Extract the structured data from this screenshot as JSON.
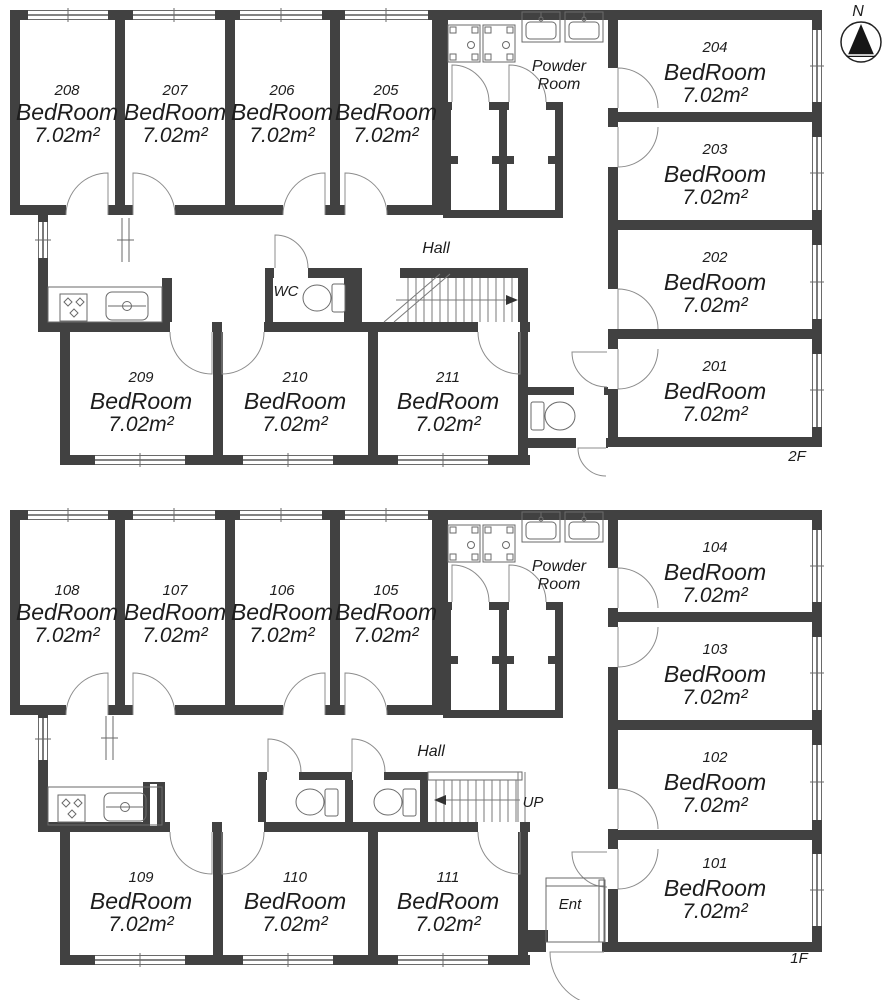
{
  "compass": {
    "north": "N"
  },
  "floor_2f": {
    "floor_label": "2F",
    "hall_label": "Hall",
    "wc_label": "WC",
    "powder_line1": "Powder",
    "powder_line2": "Room",
    "rooms_top": [
      {
        "number": "208",
        "type": "BedRoom",
        "area": "7.02m²"
      },
      {
        "number": "207",
        "type": "BedRoom",
        "area": "7.02m²"
      },
      {
        "number": "206",
        "type": "BedRoom",
        "area": "7.02m²"
      },
      {
        "number": "205",
        "type": "BedRoom",
        "area": "7.02m²"
      }
    ],
    "rooms_right": [
      {
        "number": "204",
        "type": "BedRoom",
        "area": "7.02m²"
      },
      {
        "number": "203",
        "type": "BedRoom",
        "area": "7.02m²"
      },
      {
        "number": "202",
        "type": "BedRoom",
        "area": "7.02m²"
      },
      {
        "number": "201",
        "type": "BedRoom",
        "area": "7.02m²"
      }
    ],
    "rooms_bottom": [
      {
        "number": "209",
        "type": "BedRoom",
        "area": "7.02m²"
      },
      {
        "number": "210",
        "type": "BedRoom",
        "area": "7.02m²"
      },
      {
        "number": "211",
        "type": "BedRoom",
        "area": "7.02m²"
      }
    ]
  },
  "floor_1f": {
    "floor_label": "1F",
    "hall_label": "Hall",
    "up_label": "UP",
    "ent_label": "Ent",
    "powder_line1": "Powder",
    "powder_line2": "Room",
    "rooms_top": [
      {
        "number": "108",
        "type": "BedRoom",
        "area": "7.02m²"
      },
      {
        "number": "107",
        "type": "BedRoom",
        "area": "7.02m²"
      },
      {
        "number": "106",
        "type": "BedRoom",
        "area": "7.02m²"
      },
      {
        "number": "105",
        "type": "BedRoom",
        "area": "7.02m²"
      }
    ],
    "rooms_right": [
      {
        "number": "104",
        "type": "BedRoom",
        "area": "7.02m²"
      },
      {
        "number": "103",
        "type": "BedRoom",
        "area": "7.02m²"
      },
      {
        "number": "102",
        "type": "BedRoom",
        "area": "7.02m²"
      },
      {
        "number": "101",
        "type": "BedRoom",
        "area": "7.02m²"
      }
    ],
    "rooms_bottom": [
      {
        "number": "109",
        "type": "BedRoom",
        "area": "7.02m²"
      },
      {
        "number": "110",
        "type": "BedRoom",
        "area": "7.02m²"
      },
      {
        "number": "111",
        "type": "BedRoom",
        "area": "7.02m²"
      }
    ]
  }
}
